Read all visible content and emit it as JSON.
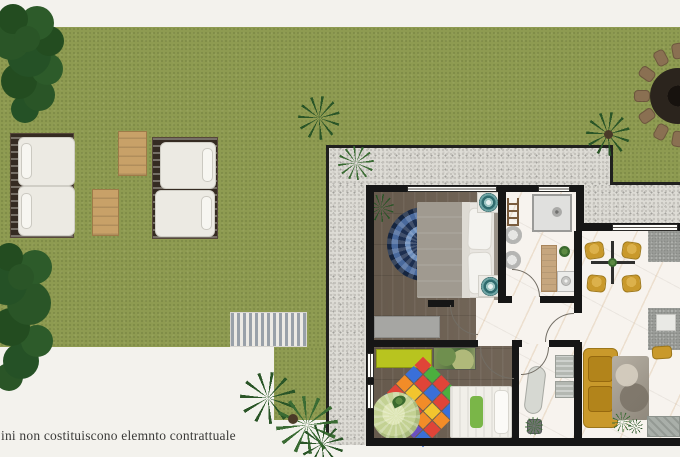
{
  "disclaimer": "ini non costituiscono elemnto contrattuale",
  "palette": {
    "page_bg": "#f3f2ed",
    "lawn_green": "#8e9b51",
    "gravel_gray": "#dedcd6",
    "wall_black": "#161616",
    "wood_floor": "#6c5f51",
    "marble_floor": "#f7f3ee",
    "tree_green": "#2a5527",
    "mustard_accent": "#c9992b",
    "teal_accent": "#6fa5a5",
    "mandala_blue": "#24375a",
    "lounger_cushion": "#eceae3",
    "lounger_base": "#352b22",
    "wood_table_tan": "#c8a168",
    "kids_wardrobe_lime": "#b8c41f"
  },
  "kids_rug_palette": [
    "#e04438",
    "#f2c52e",
    "#3a6fd8",
    "#4caf3e",
    "#f28c28",
    "#6b4fc0"
  ]
}
